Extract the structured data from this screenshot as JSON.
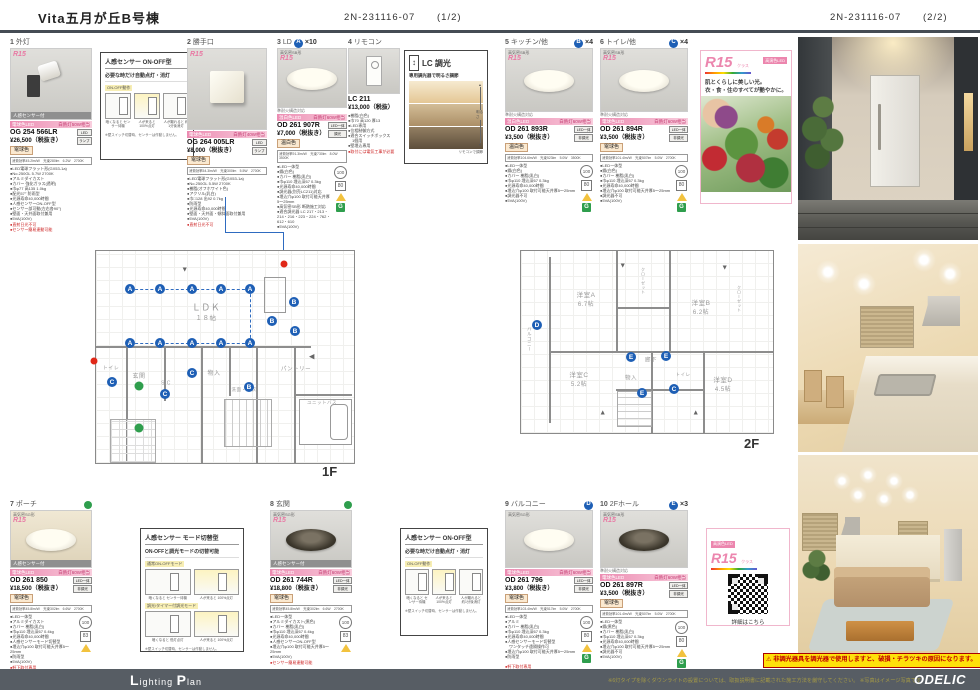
{
  "colors": {
    "accent_pink": "#ec86ae",
    "marker_blue": "#1e5fb5",
    "marker_green": "#2f9e4d",
    "alert_red": "#e02818",
    "footer_gray": "#575d64",
    "warn_yellow": "#ffe10a"
  },
  "header": {
    "title": "Vita五月が丘B号棟",
    "doc1": "2N-231116-07",
    "pg1": "(1/2)",
    "doc2": "2N-231116-07",
    "pg2": "(2/2)"
  },
  "cards": {
    "c1": {
      "no": "1",
      "label": "外灯",
      "mk": "",
      "cnt": "",
      "tag": "",
      "r15": "R15",
      "sensor": "人感センサー付",
      "fire": "",
      "pinkL": "電球色LED",
      "pinkR": "白熱灯50W相当",
      "model": "OG 254 566LR",
      "price": "¥26,500（税抜き）",
      "chip1": "LED",
      "chip2": "ランプ",
      "color": "電球色",
      "spec": "消費効率45.2lm/W　光束280lm　6.2W　2700K",
      "bullets": "●LED電球フラット形(GX53-1a)\n●No.250GL 5.7W 2700K\n●アルミダイカスト\n●カバー 強化ガラス(透明)\n●巾φ77 高135 1.0kg\n●配光57° 防雨型\n●光源寿命40,000時間\n●人感センサーON-OFF型\n●センサー部可動(左右各90°)\n●壁面・天井面取付兼用\n●5VA(100V)",
      "red": "●直射日光不可\n●センサー簡易連動可能"
    },
    "c2": {
      "no": "2",
      "label": "勝手口",
      "mk": "",
      "cnt": "",
      "tag": "",
      "r15": "R15",
      "fire": "",
      "pinkL": "電球色LED",
      "pinkR": "白熱灯40W相当",
      "model": "OG 264 005LR",
      "price": "¥8,000（税抜き）",
      "chip1": "LED",
      "chip2": "ランプ",
      "color": "電球色",
      "spec": "消費効率54.3lm/W　光束300lm　5.5W　2700K",
      "bullets": "●LED電球フラット形(GX53-1a)\n●No.250GL 5.5W 2700K\n●樹脂(オフホワイト色)\n●アクリル(乳白)\n●巾□128 出92 0.7kg\n●防雨型\n●光源寿命40,000時間\n●壁面・天井面・傾斜面取付兼用\n●5VA(100V)",
      "red": "●直射日光不可"
    },
    "c3": {
      "no": "3",
      "label": "LD",
      "mk": "A",
      "cnt": "×10",
      "tag": "高気密SB形",
      "r15": "R15",
      "fire": "準耐火構造対応",
      "pinkL": "温白色LED",
      "pinkR": "白熱灯60W相当",
      "model": "OD 261 907R",
      "price": "¥7,000（税抜き）",
      "chip1": "LED一体",
      "chip2": "調光",
      "color": "温白色",
      "spec": "消費効率91.3lm/W　光束730lm　8.0W　3500K",
      "bullets": "●LED一体型\n●鋼(白色)\n●カバー 樹脂(乳白)\n●巾φ110 埋込深67 0.3kg\n●光源寿命40,000時間\n●調光器(別売LC211)対応\n●埋込穴φ100 取付可能天井厚5〜25mm\n●高気密SB形 断熱施工対応\n●適合調光器 LC 217・213・214・216・223・224・762・612・610\n●5VA(100V)",
      "red": "",
      "b100": "100",
      "bbox": "80",
      "bg": "G"
    },
    "c4": {
      "no": "4",
      "label": "リモコン",
      "model": "LC 211",
      "price": "¥13,000（税抜）",
      "bullets": "●樹脂(白色)\n●巾70 高120 厚13\n●LED専用\n●位相制御方式\n●適合スイッチボックス\n　1個用\n●壁埋込専用",
      "red": "●取付には電気工事が必要"
    },
    "c5": {
      "no": "5",
      "label": "キッチン/他",
      "mk": "B",
      "cnt": "×4",
      "tag": "高気密SB形",
      "r15": "R15",
      "fire": "準耐火構造対応",
      "pinkL": "温白色LED",
      "pinkR": "白熱灯60W相当",
      "model": "OD 261 893R",
      "price": "¥3,500（税抜き）",
      "chip1": "LED一体",
      "chip2": "非調光",
      "color": "温白色",
      "spec": "消費効率104.6lm/W　光束523lm　5.0W　3500K",
      "bullets": "●LED一体型\n●鋼(白色)\n●カバー 樹脂(乳白)\n●巾φ110 埋込深67 0.3kg\n●光源寿命40,000時間\n●埋込穴φ100 取付可能天井厚5〜25mm\n●調光器不可\n●5VA(100V)",
      "red": "",
      "b100": "100",
      "bbox": "80",
      "bg": "G"
    },
    "c6": {
      "no": "6",
      "label": "トイレ/他",
      "mk": "C",
      "cnt": "×4",
      "tag": "高気密SB形",
      "r15": "R15",
      "fire": "準耐火構造対応",
      "pinkL": "電球色LED",
      "pinkR": "白熱灯60W相当",
      "model": "OD 261 894R",
      "price": "¥3,500（税抜き）",
      "chip1": "LED一体",
      "chip2": "非調光",
      "color": "電球色",
      "spec": "消費効率101.4lm/W　光束507lm　5.0W　2700K",
      "bullets": "●LED一体型\n●鋼(白色)\n●カバー 樹脂(乳白)\n●巾φ110 埋込深67 0.3kg\n●光源寿命40,000時間\n●埋込穴φ100 取付可能天井厚5〜25mm\n●調光器不可\n●5VA(100V)",
      "red": "",
      "b100": "100",
      "bbox": "80",
      "bg": "G"
    },
    "c7": {
      "no": "7",
      "label": "ポーチ",
      "mk": "",
      "cnt": "",
      "tag": "高気密SG形",
      "r15": "R15",
      "sensor": "人感センサー付",
      "fire": "",
      "pinkL": "電球色LED",
      "pinkR": "白熱灯60W相当",
      "model": "OD 261 850",
      "price": "¥18,500（税抜き）",
      "chip1": "LED一体",
      "chip2": "非調光",
      "color": "電球色",
      "spec": "消費効率45.8lm/W　光束302lm　6.6W　2700K",
      "bullets": "●LED一体型\n●アルミダイカスト\n●カバー 樹脂(乳白)\n●巾φ110 埋込深67 0.4kg\n●光源寿命40,000時間\n●人感センサーモード切替型\n●埋込穴φ100 取付可能天井厚5〜25mm\n●防雨型\n●5VA(100V)",
      "red": "●軒下取付専用\n●センサー簡易連動可能",
      "b100": "100",
      "bbox": "83",
      "bg": ""
    },
    "c8": {
      "no": "8",
      "label": "玄関",
      "mk": "",
      "cnt": "",
      "tag": "高気密SG形",
      "r15": "R15",
      "sensor": "人感センサー付",
      "fire": "",
      "pinkL": "電球色LED",
      "pinkR": "白熱灯60W相当",
      "model": "OD 261 744R",
      "price": "¥18,800（税抜き）",
      "chip1": "LED一体",
      "chip2": "非調光",
      "color": "電球色",
      "spec": "消費効率45.8lm/W　光束302lm　6.6W　2700K",
      "bullets": "●LED一体型\n●アルミダイカスト(黒色)\n●カバー 樹脂(乳白)\n●巾φ110 埋込深67 0.4kg\n●光源寿命40,000時間\n●人感センサーON-OFF型\n●埋込穴φ100 取付可能天井厚5〜25mm\n●5VA(100V)",
      "red": "●センサー簡易連動可能",
      "b100": "100",
      "bbox": "83",
      "bg": ""
    },
    "c9": {
      "no": "9",
      "label": "バルコニー",
      "mk": "D",
      "cnt": "",
      "tag": "高気密SG形",
      "r15": "",
      "fire": "",
      "pinkL": "電球色LED",
      "pinkR": "白熱灯60W相当",
      "model": "OD 261 796",
      "price": "¥3,800（税抜き）",
      "chip1": "LED一体",
      "chip2": "非調光",
      "color": "電球色",
      "spec": "消費効率103.4lm/W　光束517lm　5.0W　2700K",
      "bullets": "●LED一体型\n●アルミ\n●カバー 樹脂(乳白)\n●巾φ110 埋込深67 0.3kg\n●光源寿命40,000時間\n●人感センサーモード切替型\n　ワンタッチ遠隔操作可\n●埋込穴φ100 取付可能天井厚5〜25mm\n●防雨型",
      "red": "●軒下取付専用",
      "b100": "100",
      "bbox": "80",
      "bg": "G"
    },
    "c10": {
      "no": "10",
      "label": "2Fホール",
      "mk": "E",
      "cnt": "×3",
      "tag": "高気密SB形",
      "r15": "R15",
      "fire": "準耐火構造対応",
      "pinkL": "電球色LED",
      "pinkR": "白熱灯60W相当",
      "model": "OD 261 897R",
      "price": "¥3,500（税抜き）",
      "chip1": "LED一体",
      "chip2": "非調光",
      "color": "電球色",
      "spec": "消費効率101.4lm/W　光束507lm　5.0W　2700K",
      "bullets": "●LED一体型\n●鋼(黒色)\n●カバー 樹脂(乳白)\n●巾φ110 埋込深67 0.3kg\n●光源寿命40,000時間\n●埋込穴φ100 取付可能天井厚5〜25mm\n●調光器不可\n●5VA(100V)",
      "red": "",
      "b100": "100",
      "bbox": "80",
      "bg": "G"
    }
  },
  "info_onoff": {
    "title": "人感センサー ON-OFF型",
    "sub": "必要な時だけ自動点灯・消灯",
    "lab": "ON-OFF動作",
    "cap1": "暗くなると\nセンサー待機",
    "cap2": "人が来ると\n100%点灯",
    "cap3": "人が離れると\n約1分後消灯",
    "note": "※壁スイッチ切替時、センサーは作動しません。"
  },
  "info_mode": {
    "title": "人感センサー モード切替型",
    "sub": "ON-OFFと調光モードの切替可能",
    "lab1": "通常ON-OFFモード",
    "m1c1": "暗くなると\nセンサー待機",
    "m1c2": "人が来ると\n100%点灯",
    "lab2": "調光/タイマー付調光モード",
    "m2c1": "暗くなると\n低灯点灯",
    "m2c2": "人が来ると\n100%点灯",
    "note": "※壁スイッチ切替時、センサーは作動しません。"
  },
  "lc": {
    "t1": "LC",
    "t2": "調光",
    "arrow": "↕",
    "sub": "専用調光器で明るさ調節",
    "side": "明るさ",
    "foot": "リモコンで調節"
  },
  "promo": {
    "logo": "R15",
    "logosub": "クラス",
    "tag": "高演色LED",
    "copy": "肌とくらしに美しい光。\n衣・食・住のすべてが艶やかに。"
  },
  "qr": {
    "logo": "R15",
    "logosub": "クラス",
    "tag": "高演色LED",
    "link": "詳細はこちら"
  },
  "plan1f": {
    "label": "1F",
    "rooms": [
      {
        "x": 110,
        "y": 57,
        "t": "ＬＤＫ",
        "s": 9
      },
      {
        "x": 110,
        "y": 68,
        "t": "１８帖",
        "s": 6.5
      },
      {
        "x": 15,
        "y": 118,
        "t": "トイレ",
        "s": 5
      },
      {
        "x": 43,
        "y": 126,
        "t": "玄関",
        "s": 6
      },
      {
        "x": 70,
        "y": 133,
        "t": "SIC",
        "s": 5
      },
      {
        "x": 118,
        "y": 123,
        "t": "物入",
        "s": 6
      },
      {
        "x": 148,
        "y": 139,
        "t": "洗面・脱衣",
        "s": 4.5
      },
      {
        "x": 200,
        "y": 119,
        "t": "パントリー",
        "s": 5.5
      },
      {
        "x": 226,
        "y": 152,
        "t": "ユニットバス",
        "s": 4.5
      },
      {
        "x": 89,
        "y": 19,
        "t": "▼",
        "s": 7,
        "c": "#666"
      },
      {
        "x": 216,
        "y": 106,
        "t": "◀",
        "s": 7,
        "c": "#666"
      }
    ],
    "marks": [
      {
        "x": 34,
        "y": 38,
        "t": "A",
        "c": "b"
      },
      {
        "x": 64,
        "y": 38,
        "t": "A",
        "c": "b"
      },
      {
        "x": 96,
        "y": 38,
        "t": "A",
        "c": "b"
      },
      {
        "x": 125,
        "y": 38,
        "t": "A",
        "c": "b"
      },
      {
        "x": 154,
        "y": 38,
        "t": "A",
        "c": "b"
      },
      {
        "x": 34,
        "y": 92,
        "t": "A",
        "c": "b"
      },
      {
        "x": 64,
        "y": 92,
        "t": "A",
        "c": "b"
      },
      {
        "x": 96,
        "y": 92,
        "t": "A",
        "c": "b"
      },
      {
        "x": 125,
        "y": 92,
        "t": "A",
        "c": "b"
      },
      {
        "x": 154,
        "y": 92,
        "t": "A",
        "c": "b"
      },
      {
        "x": 198,
        "y": 51,
        "t": "B",
        "c": "b"
      },
      {
        "x": 176,
        "y": 70,
        "t": "B",
        "c": "b"
      },
      {
        "x": 199,
        "y": 80,
        "t": "B",
        "c": "b"
      },
      {
        "x": 153,
        "y": 136,
        "t": "B",
        "c": "b"
      },
      {
        "x": 16,
        "y": 131,
        "t": "C",
        "c": "b"
      },
      {
        "x": 69,
        "y": 143,
        "t": "C",
        "c": "b"
      },
      {
        "x": 96,
        "y": 122,
        "t": "C",
        "c": "b"
      },
      {
        "x": 43,
        "y": 135,
        "t": "",
        "c": "g"
      },
      {
        "x": 43,
        "y": 177,
        "t": "",
        "c": "g"
      },
      {
        "x": 188,
        "y": 13,
        "t": "",
        "c": "r"
      },
      {
        "x": -2,
        "y": 110,
        "t": "",
        "c": "r"
      }
    ]
  },
  "plan2f": {
    "label": "2F",
    "rooms": [
      {
        "x": 65,
        "y": 45,
        "t": "洋室A",
        "s": 6.5
      },
      {
        "x": 65,
        "y": 54,
        "t": "6.7帖",
        "s": 6
      },
      {
        "x": 180,
        "y": 53,
        "t": "洋室B",
        "s": 6.5
      },
      {
        "x": 180,
        "y": 62,
        "t": "6.2帖",
        "s": 6
      },
      {
        "x": 58,
        "y": 125,
        "t": "洋室C",
        "s": 6.5
      },
      {
        "x": 58,
        "y": 134,
        "t": "5.2帖",
        "s": 6
      },
      {
        "x": 202,
        "y": 130,
        "t": "洋室D",
        "s": 6.5
      },
      {
        "x": 202,
        "y": 139,
        "t": "4.5帖",
        "s": 6
      },
      {
        "x": 130,
        "y": 110,
        "t": "廊下",
        "s": 5.5
      },
      {
        "x": 110,
        "y": 128,
        "t": "物入",
        "s": 5.5
      },
      {
        "x": 162,
        "y": 124,
        "t": "トイレ",
        "s": 4.5
      },
      {
        "x": 8,
        "y": 88,
        "t": "バルコニー",
        "s": 4.5,
        "v": 1
      },
      {
        "x": 122,
        "y": 30,
        "t": "クローゼット",
        "s": 4,
        "v": 1
      },
      {
        "x": 218,
        "y": 48,
        "t": "クローゼット",
        "s": 4,
        "v": 1
      },
      {
        "x": 102,
        "y": 15,
        "t": "▼",
        "s": 7,
        "c": "#666"
      },
      {
        "x": 204,
        "y": 17,
        "t": "▼",
        "s": 7,
        "c": "#666"
      },
      {
        "x": 82,
        "y": 162,
        "t": "▲",
        "s": 7,
        "c": "#666"
      },
      {
        "x": 175,
        "y": 162,
        "t": "▲",
        "s": 7,
        "c": "#666"
      }
    ],
    "marks": [
      {
        "x": 16,
        "y": 74,
        "t": "D",
        "c": "b"
      },
      {
        "x": 110,
        "y": 106,
        "t": "E",
        "c": "b"
      },
      {
        "x": 145,
        "y": 105,
        "t": "E",
        "c": "b"
      },
      {
        "x": 121,
        "y": 142,
        "t": "E",
        "c": "b"
      },
      {
        "x": 153,
        "y": 138,
        "t": "C",
        "c": "b"
      }
    ]
  },
  "photos": {
    "p1": "玄関ポーチ夜景イメージ",
    "p2": "キッチンイメージ",
    "p3": "リビングイメージ"
  },
  "warn": {
    "icon": "⚠",
    "text": "非調光器具を調光器で使用しますと、破損・チラツキの原因になります。"
  },
  "footer": {
    "b1": "L",
    "b2": "ighting ",
    "b3": "P",
    "b4": "lan",
    "note": "※6灯タイプを除くダウンライトの設置については、取扱説明書に記載された施工方法を厳守してください。 ※写真はイメージ写真です",
    "logo": "ODELIC"
  }
}
